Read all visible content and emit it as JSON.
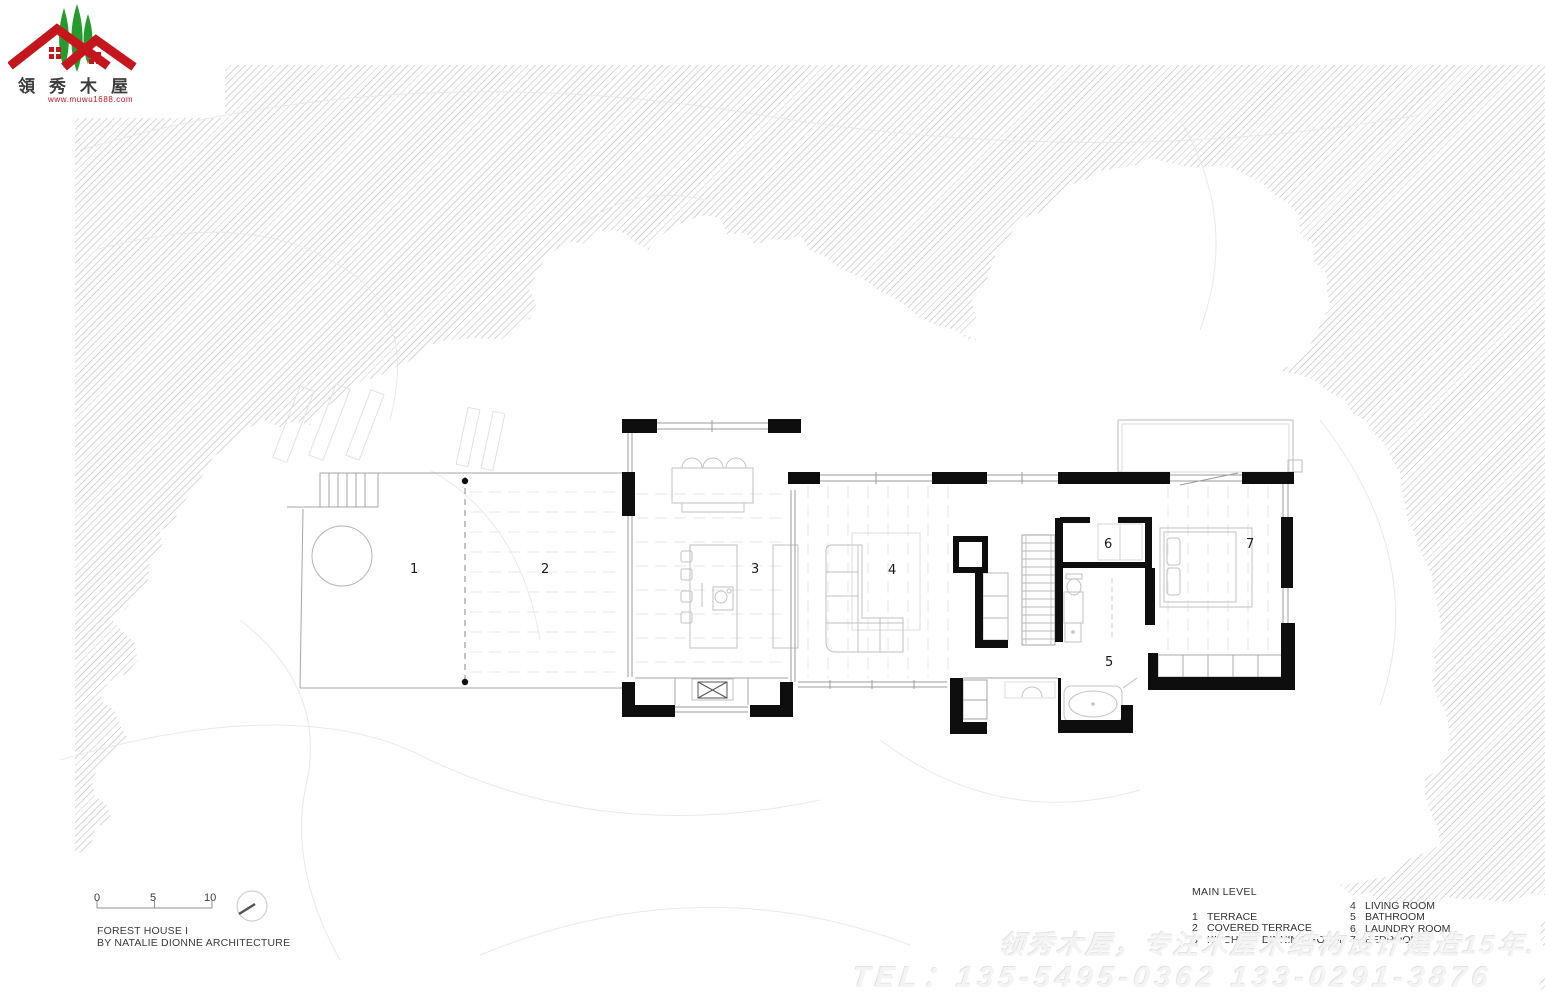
{
  "logo": {
    "title": "領秀木屋",
    "url": "www.muwu1688.com"
  },
  "plan_labels": {
    "r1": "1",
    "r2": "2",
    "r3": "3",
    "r4": "4",
    "r5": "5",
    "r6": "6",
    "r7": "7"
  },
  "legend": {
    "title": "MAIN LEVEL",
    "items_left": [
      {
        "num": "1",
        "label": "TERRACE"
      },
      {
        "num": "2",
        "label": "COVERED TERRACE"
      },
      {
        "num": "3",
        "label": "KITCHEN / DINNING ROOM"
      }
    ],
    "items_right": [
      {
        "num": "4",
        "label": "LIVING ROOM"
      },
      {
        "num": "5",
        "label": "BATHROOM"
      },
      {
        "num": "6",
        "label": "LAUNDRY ROOM"
      },
      {
        "num": "7",
        "label": "BEDROOM"
      }
    ]
  },
  "scalebar": {
    "t0": "0",
    "t5": "5",
    "t10": "10"
  },
  "title_block": {
    "line1": "FOREST HOUSE I",
    "line2": "BY NATALIE DIONNE ARCHITECTURE"
  },
  "watermark": {
    "line1": "领秀木屋，专注木屋木结构设计建造15年.",
    "line2": "TEL：135-5495-0362 133-0291-3876"
  },
  "colors": {
    "roof_red": "#c5161d",
    "tree_green": "#259b2e",
    "wall_black": "#0e0e0e"
  }
}
